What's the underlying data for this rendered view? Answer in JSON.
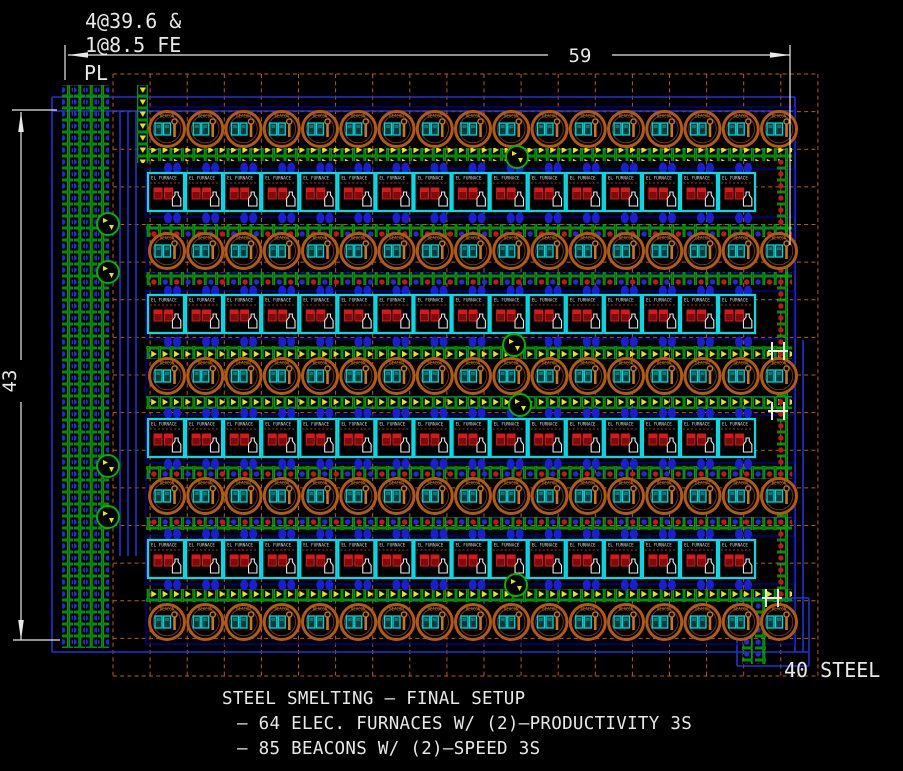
{
  "annotations": {
    "ratio_line1": "4@39.6 &",
    "ratio_line2": "1@8.5 FE",
    "pl_label": "PL",
    "dim_width": "59",
    "dim_height": "43",
    "output_label": "40 STEEL"
  },
  "caption": {
    "line1": "STEEL SMELTING – FINAL SETUP",
    "line2": "– 64 ELEC. FURNACES W/ (2)–PRODUCTIVITY 3S",
    "line3": "– 85 BEACONS W/ (2)–SPEED 3S"
  },
  "entities": {
    "beacon": {
      "label": "BEACON",
      "count": 85,
      "modules": "(2) SPEED 3S"
    },
    "furnace": {
      "label": "EL FURNACE",
      "count": 64,
      "modules": "(2) PRODUCTIVITY 3S"
    }
  },
  "colors": {
    "background": "#000000",
    "grid": "#b85c12",
    "white": "#e8e8e8",
    "belt_green": "#00b400",
    "arrow_yellow": "#e8e800",
    "item_blue": "#2228dd",
    "item_red": "#cc1414",
    "beacon_orange": "#b45a10",
    "beacon_inner": "#713708",
    "module_cyan": "#00d8d8",
    "module_red": "#d81818",
    "module_red_dark": "#7c0c0c",
    "furnace_cyan": "#00dce8",
    "inserter_blue": "#1c1cd0",
    "line_blue": "#2030d8",
    "row_blue": "#0000a0",
    "label_orange": "#cc7d1e",
    "wrench_orange": "#c87818"
  },
  "diagram": {
    "canvas": {
      "w": 903,
      "h": 771
    },
    "grid": {
      "x": 113,
      "y": 74,
      "cols": 19,
      "rows": 16,
      "pitch_x": 37.1,
      "pitch_y": 37.625
    },
    "beacon_rows": {
      "cy": [
        129,
        251,
        376,
        496,
        622
      ],
      "start_cx": 167,
      "spacing": 38.25,
      "per_row": 17,
      "r": 17.5
    },
    "furnace_rows": {
      "top": [
        173,
        295,
        419,
        540
      ],
      "start_x": 148,
      "spacing": 38.07,
      "per_row": 16,
      "w": 36,
      "h": 38
    },
    "belts_h": [
      {
        "y": 148,
        "kind": "arrow"
      },
      {
        "y": 224,
        "kind": "mix"
      },
      {
        "y": 272,
        "kind": "mix"
      },
      {
        "y": 346,
        "kind": "arrow"
      },
      {
        "y": 396,
        "kind": "arrow"
      },
      {
        "y": 466,
        "kind": "mix"
      },
      {
        "y": 517,
        "kind": "mix"
      },
      {
        "y": 589,
        "kind": "arrow"
      }
    ],
    "belt_x1": 146,
    "belt_x2": 792,
    "belt_h": 13,
    "inserter_rows": [
      162,
      212,
      285,
      336,
      407,
      458,
      528,
      579
    ],
    "left_lanes": {
      "x": [
        62,
        74,
        86,
        98
      ],
      "y1": 85,
      "y2": 648,
      "w": 11
    },
    "feed_lane": {
      "x": 137,
      "y1": 85,
      "y2": 163,
      "w": 11
    },
    "right_lane": {
      "x": 777,
      "y1": 160,
      "y2": 598,
      "w": 11
    },
    "out_lanes": {
      "x": [
        742,
        755
      ],
      "y1": 600,
      "y2": 664,
      "w": 11
    },
    "blue_lines": [
      [
        52,
        97,
        795,
        97
      ],
      [
        52,
        111,
        795,
        111
      ],
      [
        52,
        97,
        52,
        652
      ],
      [
        795,
        97,
        795,
        652
      ],
      [
        52,
        652,
        808,
        652
      ],
      [
        803,
        340,
        803,
        652
      ],
      [
        120,
        111,
        120,
        556
      ],
      [
        128,
        111,
        128,
        556
      ],
      [
        136,
        111,
        136,
        556
      ],
      [
        737,
        598,
        809,
        598
      ],
      [
        737,
        598,
        737,
        666
      ],
      [
        809,
        598,
        809,
        666
      ],
      [
        737,
        666,
        809,
        666
      ]
    ],
    "curves": [
      [
        517,
        157
      ],
      [
        514,
        345
      ],
      [
        520,
        405
      ],
      [
        516,
        585
      ]
    ],
    "lane_curves": [
      [
        108,
        224
      ],
      [
        108,
        272
      ],
      [
        108,
        466
      ],
      [
        108,
        517
      ]
    ],
    "h_poles": [
      [
        778,
        351
      ],
      [
        778,
        411
      ],
      [
        772,
        598
      ]
    ]
  }
}
